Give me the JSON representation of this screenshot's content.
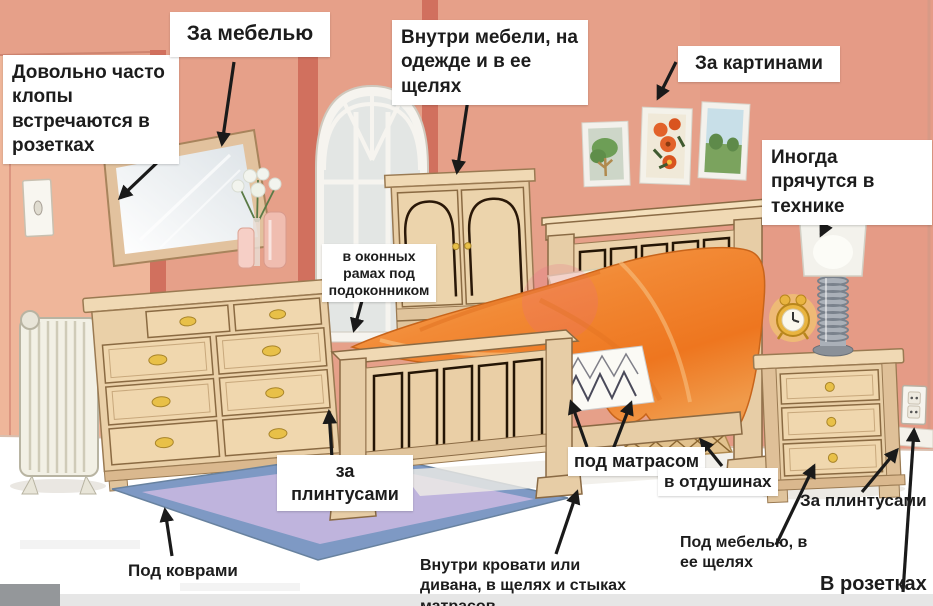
{
  "labels": {
    "outlets_often": "Довольно часто клопы встречаются в розетках",
    "behind_furniture": "За мебелью",
    "inside_furniture": "Внутри мебели, на одежде и в ее щелях",
    "behind_pictures": "За картинами",
    "in_electronics": "Иногда прячутся в технике",
    "window_frames": "в оконных рамах под подоконником",
    "behind_baseboards_left": "за плинтусами",
    "under_mattress": "под матрасом",
    "in_vents": "в отдушинах",
    "behind_baseboards_right": "За плинтусами",
    "under_furniture": "Под мебелью, в ее щелях",
    "in_outlets": "В розетках",
    "under_carpets": "Под коврами",
    "inside_bed": "Внутри кровати или дивана, в щелях и стыках матрасов"
  },
  "colors": {
    "wall": "#e6a089",
    "wall_light": "#efb69a",
    "pilaster": "#d1705e",
    "floor": "#ffffff",
    "carpet": "#bfb4dd",
    "carpet_border": "#7e99c4",
    "wood": "#ecd3ac",
    "wood_dark": "#8a6a44",
    "blanket_orange": "#f08030",
    "label_bg": "#ffffff",
    "label_text": "#1c1c1c",
    "arrow": "#1a1a1a",
    "knob_gold": "#e8c048"
  }
}
